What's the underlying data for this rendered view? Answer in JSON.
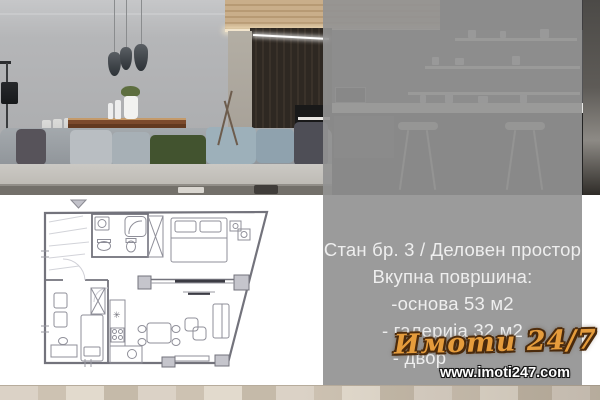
{
  "listing": {
    "title": "Стан бр. 3 / Деловен простор",
    "subtitle": "Вкупна површина:",
    "area_lines": {
      "base": "-основа 53 м2",
      "gallery": "- галерија 32 м2",
      "yard": "- двор"
    }
  },
  "brand": {
    "logo_text": "Имоти 24/7",
    "website": "www.imoti247.com"
  },
  "colors": {
    "overlay_gray": "#939393",
    "listing_text": "#eeeeee",
    "logo_orange": "#e59c3c",
    "logo_outline": "#53300f",
    "website_text": "#ffffff",
    "green_pillow": "#42532f",
    "wood_strip": "#d9d0c4"
  }
}
